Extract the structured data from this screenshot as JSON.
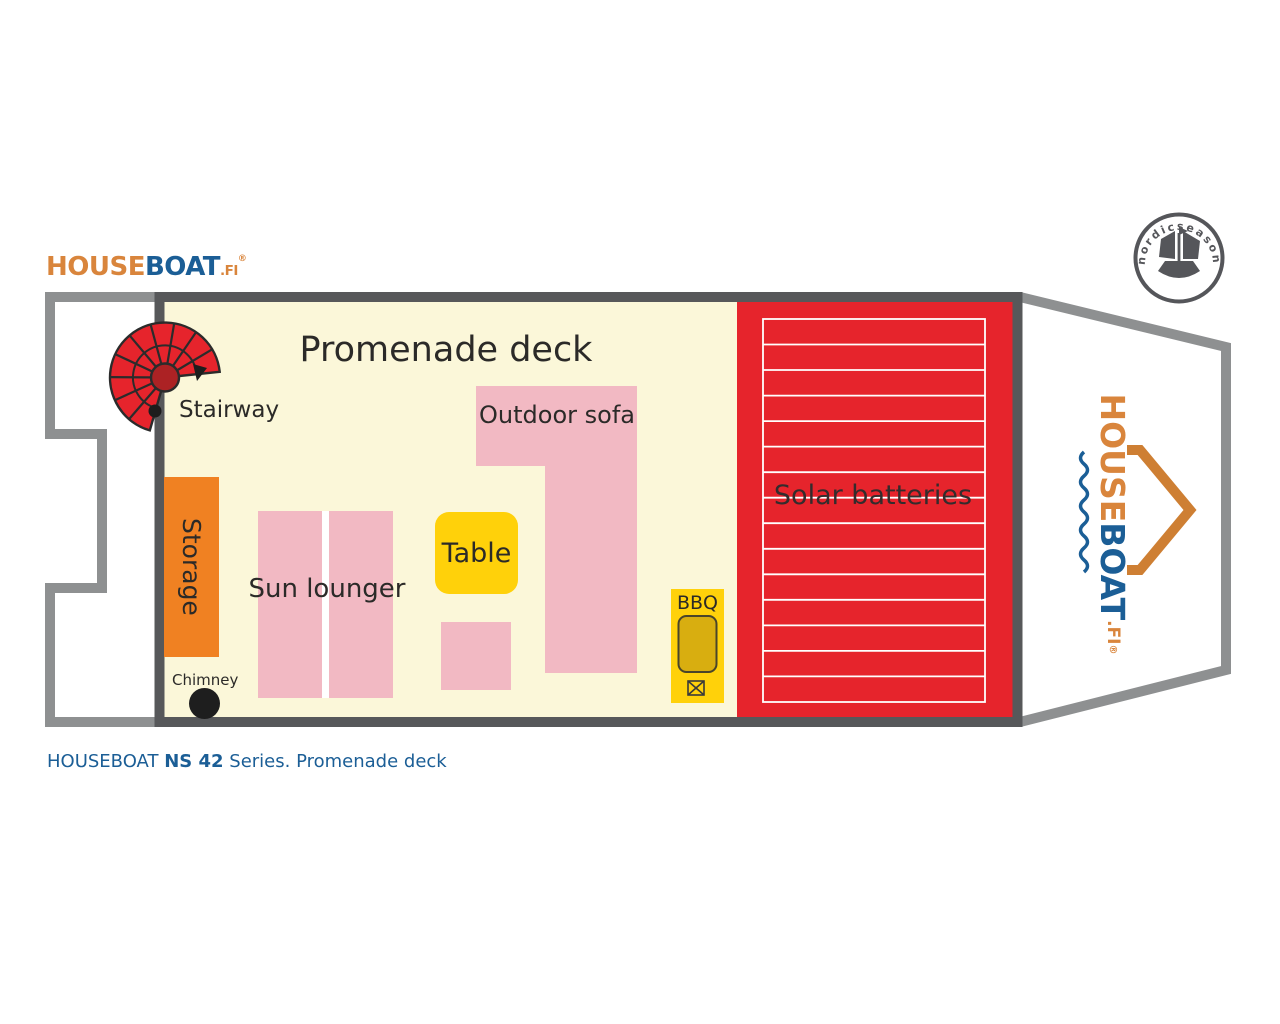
{
  "branding": {
    "logo": {
      "house": "HOUSE",
      "boat": "BOAT",
      "tld": ".FI",
      "registered": "®"
    },
    "badge_text": "nordicseason"
  },
  "plan": {
    "title": "Promenade deck",
    "labels": {
      "stairway": "Stairway",
      "storage": "Storage",
      "sun_lounger": "Sun lounger",
      "table": "Table",
      "outdoor_sofa": "Outdoor sofa",
      "bbq": "BBQ",
      "chimney": "Chimney",
      "solar_batteries": "Solar batteries"
    }
  },
  "caption": {
    "brand": "HOUSEBOAT ",
    "model": "NS 42",
    "suffix": " Series. Promenade deck"
  },
  "colors": {
    "deck_floor": "#FBF7D9",
    "furniture_pink": "#F2B9C3",
    "furniture_yellow": "#FFD10A",
    "bbq_grill": "#D8AE10",
    "storage_orange": "#F08122",
    "solar_red": "#E6242C",
    "stair_red": "#E6242C",
    "stair_hub_red": "#AC2224",
    "wall_dark": "#57585A",
    "hull_gray": "#8E9091",
    "brand_blue": "#1B5E96",
    "brand_orange": "#D9853C",
    "badge_gray": "#55565A"
  }
}
